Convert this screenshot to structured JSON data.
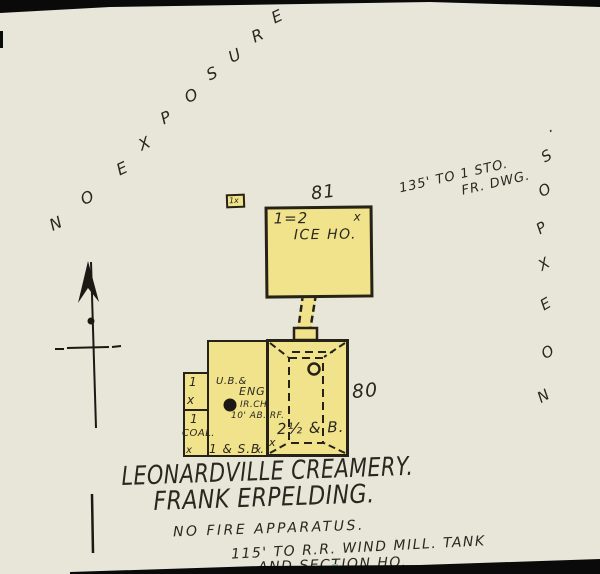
{
  "colors": {
    "paper": "#e8e5d9",
    "building_fill": "#f0e38b",
    "ink": "#2b2720",
    "scan_edge": "#0a0a0a"
  },
  "title": {
    "line1": "LEONARDVILLE CREAMERY.",
    "line2": "FRANK ERPELDING."
  },
  "annotations": {
    "no_exposure_diagonal": {
      "text": "NO EXPOSURE",
      "letters": [
        "N",
        "O",
        "E",
        "X",
        "P",
        "O",
        "S",
        "U",
        "R",
        "E"
      ]
    },
    "no_expos_vertical": {
      "text": "NO EXPOS.",
      "letters_top_to_bottom": [
        ".",
        "S",
        "O",
        "P",
        "X",
        "E",
        "O",
        "N"
      ]
    },
    "frame_dwelling_distance": {
      "line1": "135' TO 1 STO.",
      "line2": "FR. DWG."
    },
    "fire_protection_note": "NO FIRE APPARATUS.",
    "railroad_distance": {
      "line1": "115' TO R.R. WIND MILL. TANK",
      "line2": "AND SECTION HO."
    }
  },
  "buildings": {
    "shed": {
      "label": "1x"
    },
    "ice_house": {
      "lot_number": "81",
      "stories": "1=2",
      "name": "ICE HO.",
      "window_mark": "x"
    },
    "main": {
      "lot_number": "80",
      "left_top_room": {
        "stories": "1",
        "mark": "x"
      },
      "coal_room": {
        "stories": "1",
        "label": "COAL.",
        "mark": "x"
      },
      "engine_room": {
        "label_line1": "U.B.&",
        "label_line2": "ENG.",
        "chimney_label": "IR.CH.",
        "chimney_height": "10' AB. RF.",
        "basement_label": "1 & S.B.",
        "mark_right": "x"
      },
      "creamery_section": {
        "label": "2½ & B.",
        "mark": "x"
      }
    }
  }
}
